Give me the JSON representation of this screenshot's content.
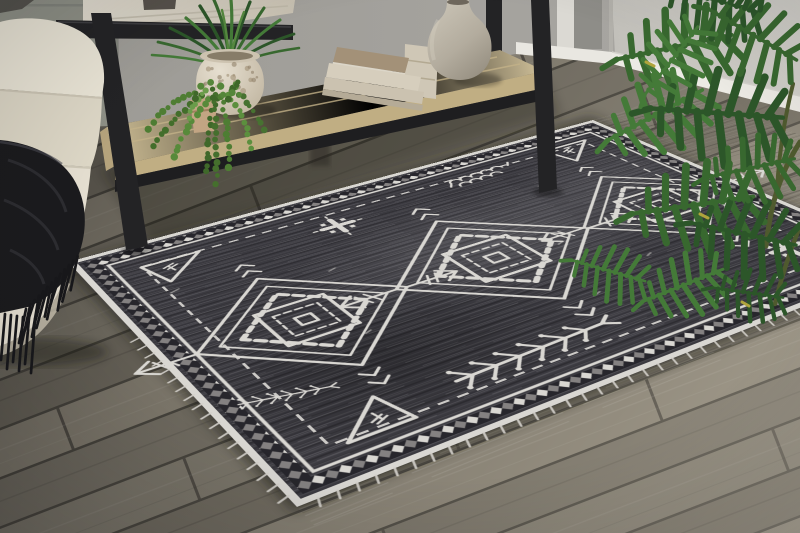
{
  "meta": {
    "type": "product-photo",
    "subject": "Charcoal gray tribal-pattern area rug with white geometric medallions, styled in a living room with a black metal console table, cream sofa with black fringed throw, wood plank floor and green houseplants"
  },
  "palette": {
    "wall_left": "#8e9086",
    "wall_center": "#a4a29e",
    "wall_right": "#cac8c2",
    "baseboard": "#e9e7e1",
    "trim": "#dbd9d3",
    "opening": "#8e8d88",
    "plank_a": "#7b766a",
    "plank_b": "#6d685d",
    "plank_c": "#847e71",
    "plank_d": "#736e63",
    "floor_seam": "#46433c",
    "rug_base": "#3b3a40",
    "rug_dark": "#28272d",
    "rug_white": "#d9d7d2",
    "sofa": "#eae5d6",
    "sofa_shade": "#ddd7c6",
    "throw": "#1a1a1d",
    "metal": "#232325",
    "wood_top": "#d8d2c5",
    "shelf": "#d3c49b",
    "shelf_face": "#c0ae83",
    "vase_light": "#c8c2b4",
    "vase_dark": "#948d7f",
    "book_cream": "#d6cebd",
    "book_brown": "#a39178",
    "pot": "#ded6c7",
    "green_dark": "#2c5629",
    "green_mid": "#38682f",
    "green_light": "#447a38",
    "bead_green": "#4e7d33",
    "stem": "#4f5a2e"
  },
  "scene": {
    "objects": [
      {
        "name": "area-rug",
        "desc": "charcoal rug, white diamond medallions, chain border, corner triangles, fringe"
      },
      {
        "name": "wood-floor",
        "desc": "gray-brown diagonal wood planks"
      },
      {
        "name": "wall",
        "desc": "gray wall with white baseboard and corner"
      },
      {
        "name": "sofa",
        "desc": "cream sofa arm and chaise"
      },
      {
        "name": "throw-blanket",
        "desc": "black throw with long fringe"
      },
      {
        "name": "console-table",
        "desc": "black metal console, whitewashed top, light wood shelf"
      },
      {
        "name": "potted-grass-plant",
        "desc": "spiky green plant in speckled round pot"
      },
      {
        "name": "trailing-plant",
        "desc": "string-of-beads plant trailing off shelf"
      },
      {
        "name": "book-stack",
        "desc": "stacked neutral hardcover books"
      },
      {
        "name": "ceramic-vase",
        "desc": "taupe gourd-shaped vase"
      },
      {
        "name": "philodendron",
        "desc": "large split-leaf green plant at right"
      }
    ]
  }
}
